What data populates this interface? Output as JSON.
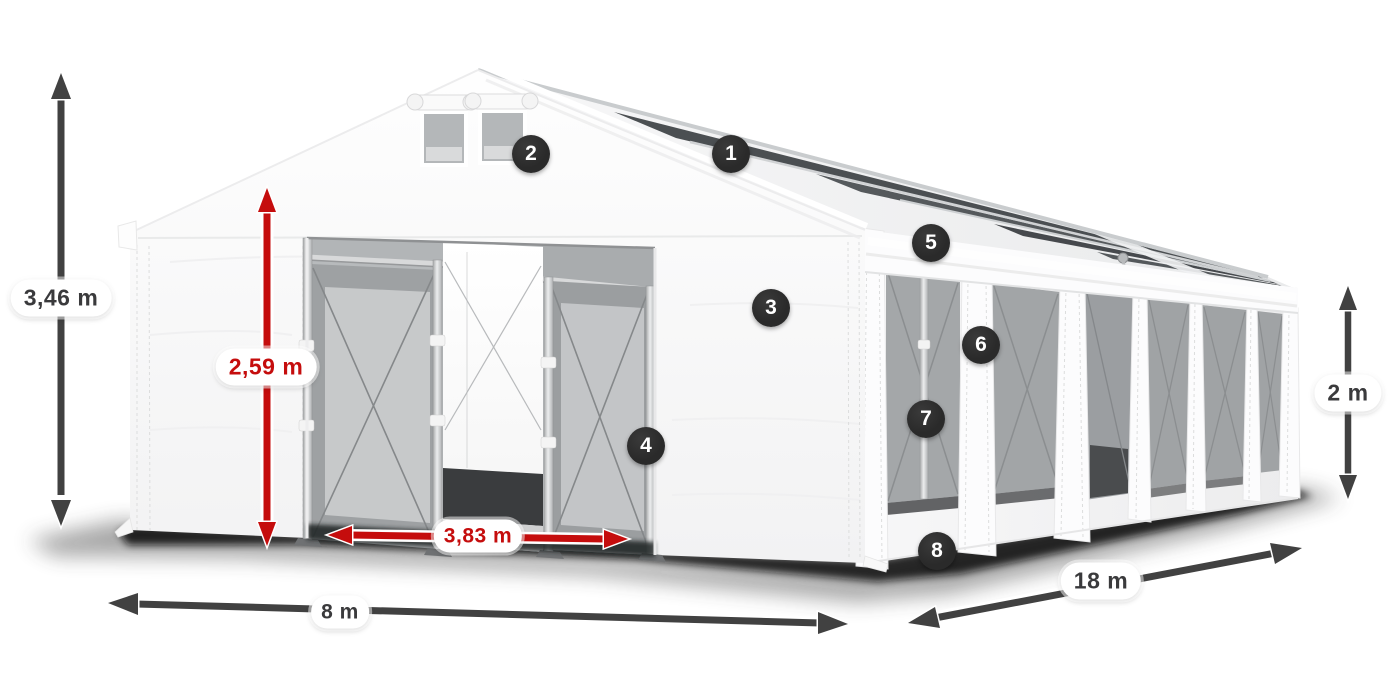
{
  "dimensions": [
    {
      "id": "total-height",
      "label": "3,46 m",
      "style": "dark"
    },
    {
      "id": "entrance-height",
      "label": "2,59 m",
      "style": "red"
    },
    {
      "id": "entrance-width",
      "label": "3,83 m",
      "style": "red"
    },
    {
      "id": "width",
      "label": "8 m",
      "style": "dark"
    },
    {
      "id": "length",
      "label": "18 m",
      "style": "dark"
    },
    {
      "id": "side-height",
      "label": "2 m",
      "style": "dark"
    }
  ],
  "callouts": [
    {
      "number": "1"
    },
    {
      "number": "2"
    },
    {
      "number": "3"
    },
    {
      "number": "4"
    },
    {
      "number": "5"
    },
    {
      "number": "6"
    },
    {
      "number": "7"
    },
    {
      "number": "8"
    }
  ],
  "colors": {
    "canvas-bg": "#ffffff",
    "arrow-dark": "#414141",
    "accent-red": "#c50d0d",
    "label-text": "#3a3a3c",
    "pill-bg": "#ffffff",
    "badge-bg": "#2a2a2a",
    "badge-text": "#ffffff"
  }
}
